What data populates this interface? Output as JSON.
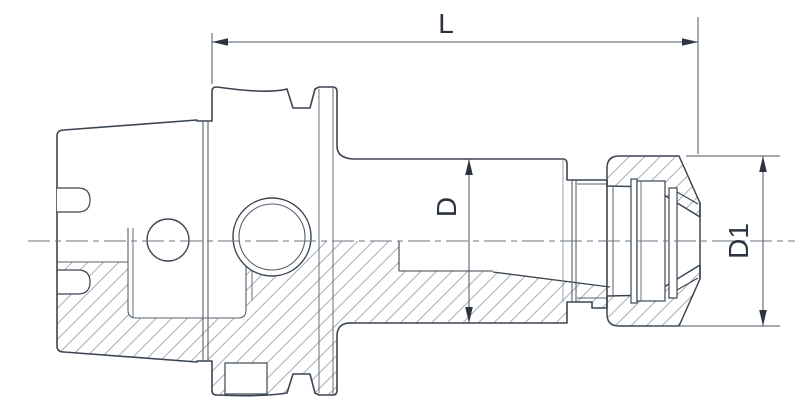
{
  "drawing": {
    "type": "technical-half-section",
    "subject": "collet-chuck-tool-holder",
    "dimension_labels": {
      "length": "L",
      "body_diameter": "D",
      "nut_diameter": "D1"
    },
    "colors": {
      "outline": "#3b4550",
      "inner_line": "#55606c",
      "hatch": "#9aa4af",
      "dimension_line": "#4a5560",
      "label_text": "#2b3440",
      "background": "#ffffff"
    }
  }
}
